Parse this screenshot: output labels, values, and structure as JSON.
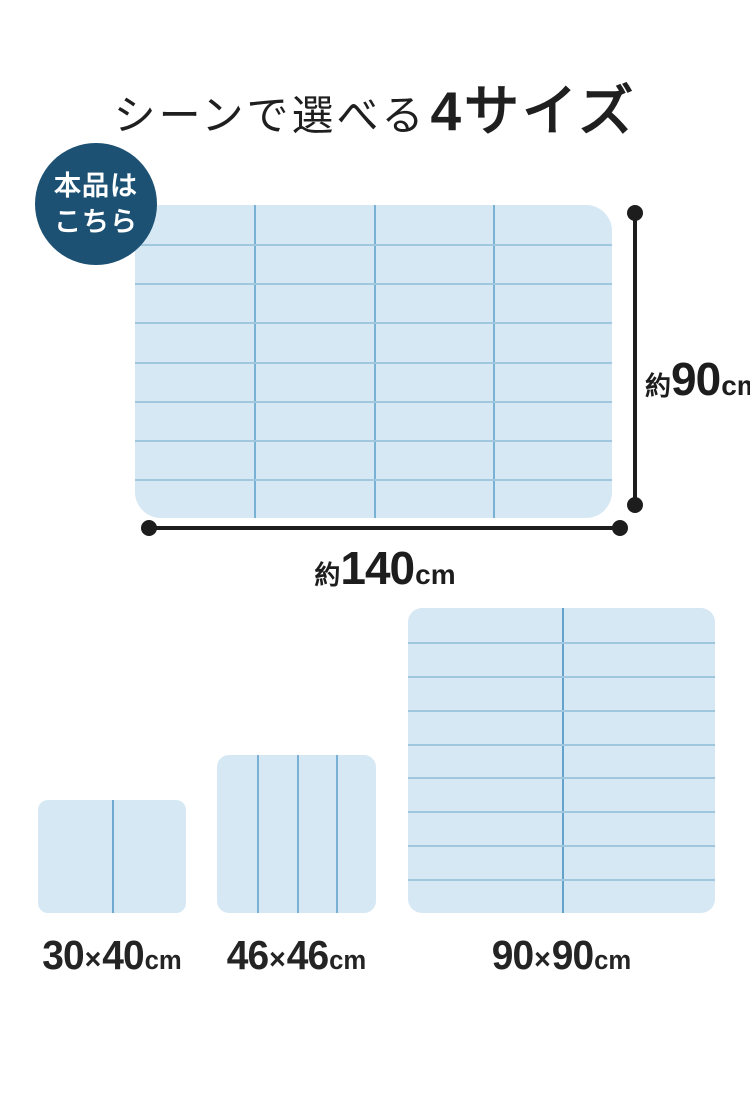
{
  "title": {
    "prefix": "シーンで選べる",
    "highlight": "4サイズ"
  },
  "badge": {
    "line1": "本品は",
    "line2": "こちら"
  },
  "main_mat": {
    "columns": 4,
    "rows": 8,
    "width_label": {
      "approx": "約",
      "value": "140",
      "unit": "cm"
    },
    "height_label": {
      "approx": "約",
      "value": "90",
      "unit": "cm"
    }
  },
  "sizes": [
    {
      "w": "30",
      "times": "×",
      "h": "40",
      "unit": "cm",
      "columns": 2,
      "rows": 1
    },
    {
      "w": "46",
      "times": "×",
      "h": "46",
      "unit": "cm",
      "columns": 4,
      "rows": 1
    },
    {
      "w": "90",
      "times": "×",
      "h": "90",
      "unit": "cm",
      "columns": 2,
      "rows": 9
    }
  ],
  "colors": {
    "background": "#ffffff",
    "mat_fill": "#d6e8f4",
    "grid_vertical": "#79b1d5",
    "grid_horizontal": "#a1c7df",
    "badge_background": "#1d5174",
    "badge_text": "#ffffff",
    "dimension_ink": "#1d1d1d",
    "title_ink": "#1f1f1f"
  }
}
